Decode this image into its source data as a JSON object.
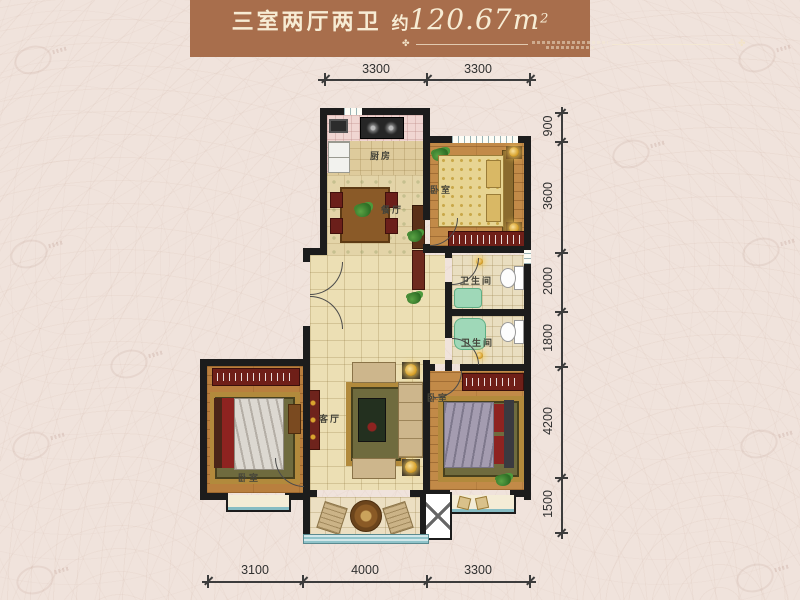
{
  "header": {
    "layout_title": "三室两厅两卫",
    "area_prefix": "约",
    "area_value": "120.67",
    "area_unit": "m",
    "area_superscript": "2",
    "ornament_glyph": "✤"
  },
  "rooms": {
    "kitchen": {
      "label": "厨房"
    },
    "dining": {
      "label": "餐厅"
    },
    "living": {
      "label": "客厅"
    },
    "bedroom_top_right": {
      "label": "卧室"
    },
    "bedroom_bottom_left": {
      "label": "卧室"
    },
    "bedroom_bottom_right": {
      "label": "卧室"
    },
    "bathroom_upper": {
      "label": "卫生间"
    },
    "bathroom_lower": {
      "label": "卫生间"
    }
  },
  "dimensions": {
    "top": [
      "3300",
      "3300"
    ],
    "right": [
      "900",
      "3600",
      "2000",
      "1800",
      "4200",
      "1500"
    ],
    "bottom": [
      "3100",
      "4000",
      "3300"
    ]
  },
  "colors": {
    "banner": "#a86e4c",
    "banner_text": "#f7ecd4",
    "background": "#f0e3dc",
    "wall": "#1c1c1c",
    "tile_floor": "#ecdfb4",
    "wood_floor": "#c28a48",
    "wardrobe_red": "#6f1f18",
    "railing_teal": "#8fc3c9",
    "fixture_green": "#9fd8b8",
    "dimension_text": "#303030"
  }
}
